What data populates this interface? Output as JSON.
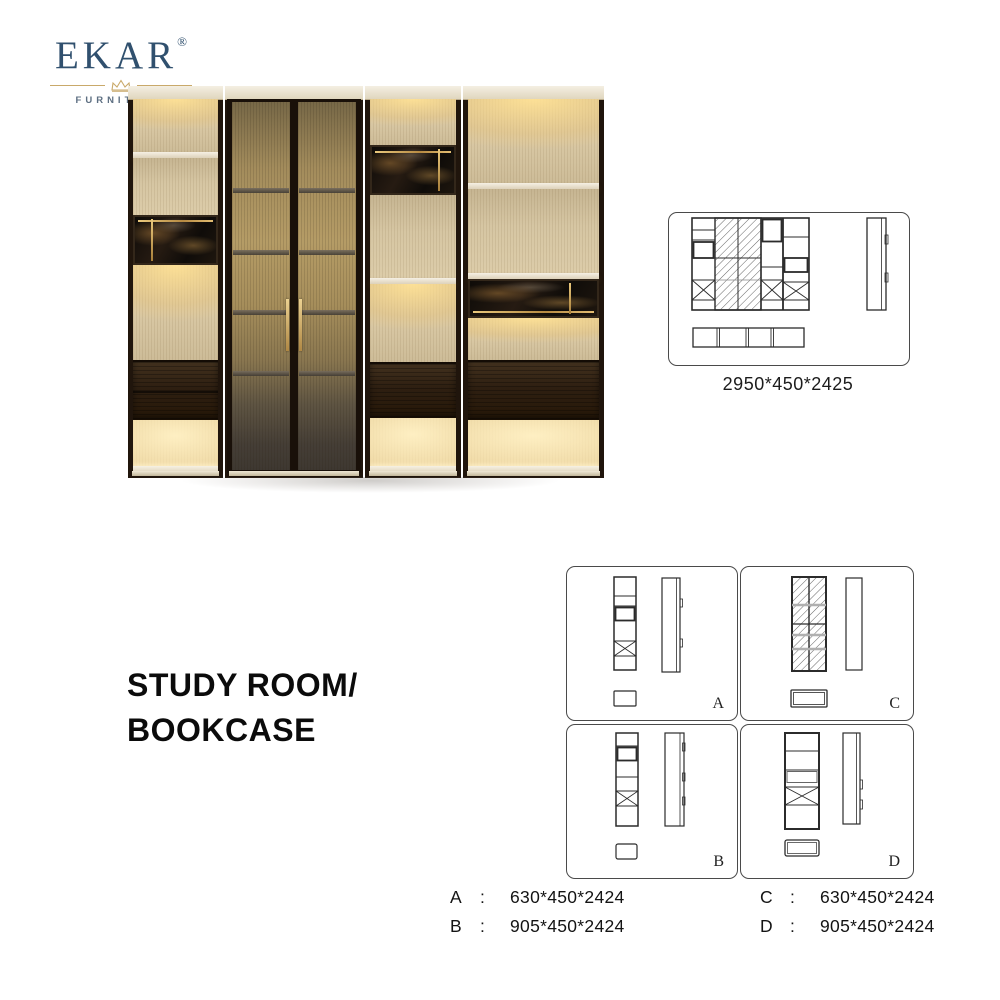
{
  "brand": {
    "name": "EKAR",
    "registered": "®",
    "tagline": "FURNITURE"
  },
  "title": {
    "line1": "STUDY ROOM/",
    "line2": "BOOKCASE"
  },
  "overview": {
    "dimensions": "2950*450*2425"
  },
  "panels": {
    "a": {
      "label": "A"
    },
    "b": {
      "label": "B"
    },
    "c": {
      "label": "C"
    },
    "d": {
      "label": "D"
    }
  },
  "specs": {
    "rows": [
      {
        "left_label": "A",
        "left_colon": ":",
        "left_value": "630*450*2424",
        "right_label": "C",
        "right_colon": ":",
        "right_value": "630*450*2424"
      },
      {
        "left_label": "B",
        "left_colon": ":",
        "left_value": "905*450*2424",
        "right_label": "D",
        "right_colon": ":",
        "right_value": "905*450*2424"
      }
    ]
  },
  "colors": {
    "brand_navy": "#30506e",
    "crown_gold": "#c9a96a",
    "accent_brass": "#c8a152",
    "frame_wood": "#20150c",
    "panel_cream": "#d6c6a3",
    "marble_dark": "#17110c"
  }
}
